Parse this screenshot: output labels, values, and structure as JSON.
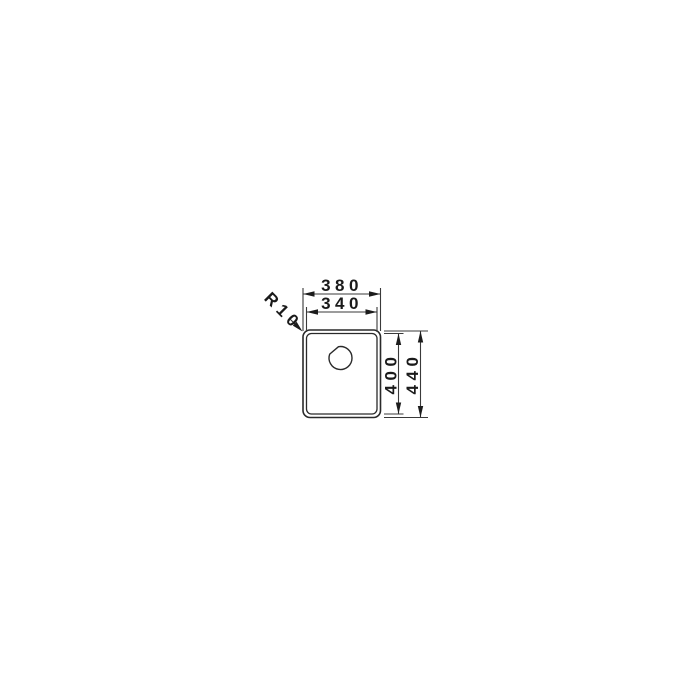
{
  "drawing": {
    "subject": "sink-bowl-plan-view-technical-drawing",
    "background_color": "#ffffff",
    "line_color": "#2a2a2a",
    "text_color": "#1a1a1a",
    "dimension_labels": {
      "outer_width": "380",
      "inner_width": "340",
      "inner_depth": "400",
      "outer_depth": "440",
      "corner_radius": "R10"
    }
  }
}
